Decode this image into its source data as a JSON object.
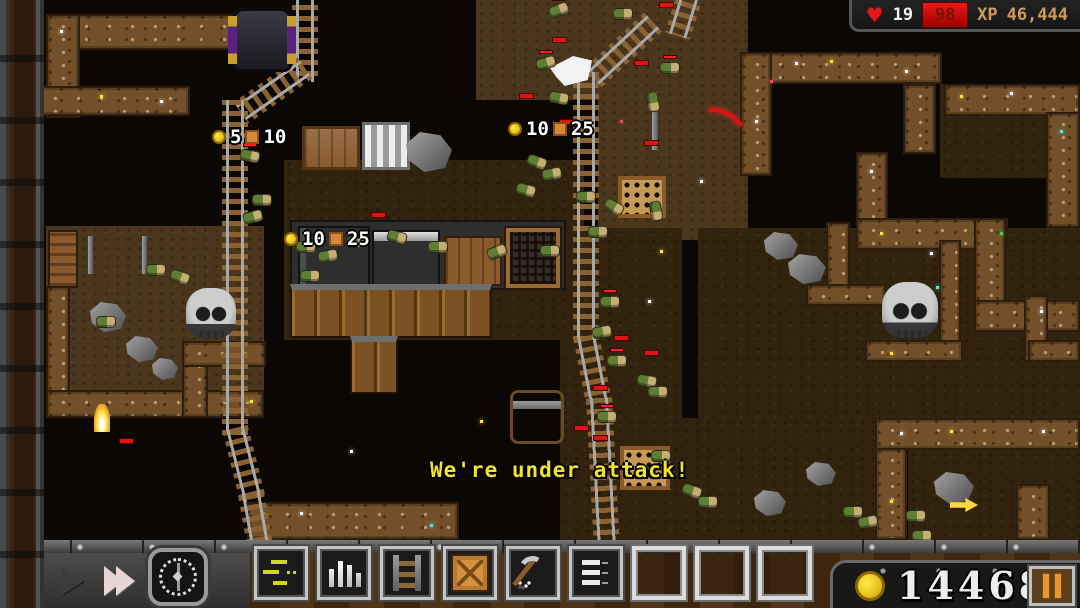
{
  "hud": {
    "lives": "19",
    "hp": "98",
    "xp_label": "XP",
    "xp_value": "46,444"
  },
  "gold": {
    "value": "14468"
  },
  "message": {
    "text": "We're under attack!",
    "x": 430,
    "y": 458
  },
  "loot_popups": [
    {
      "coin": "5",
      "crate": "10",
      "x": 212,
      "y": 126
    },
    {
      "coin": "10",
      "crate": "25",
      "x": 508,
      "y": 118
    },
    {
      "coin": "10",
      "crate": "25",
      "x": 284,
      "y": 228
    }
  ],
  "time_controls": {
    "play": "play",
    "fast_forward": "fast-forward",
    "clock": "day-night-clock"
  },
  "toolbar": {
    "slots": [
      {
        "id": 1,
        "icon": "tasks-list-icon",
        "filled": true
      },
      {
        "id": 2,
        "icon": "bar-chart-icon",
        "filled": true
      },
      {
        "id": 3,
        "icon": "ladder-icon",
        "filled": true
      },
      {
        "id": 4,
        "icon": "crate-icon",
        "filled": true
      },
      {
        "id": 5,
        "icon": "pickaxe-icon",
        "filled": true
      },
      {
        "id": 6,
        "icon": "list-icon",
        "filled": true
      },
      {
        "id": 7,
        "icon": "",
        "filled": false
      },
      {
        "id": 8,
        "icon": "",
        "filled": false
      },
      {
        "id": 9,
        "icon": "",
        "filled": false
      }
    ]
  },
  "colors": {
    "gold": "#f2d335",
    "hp_red": "#e01212",
    "xp_tan": "#d19b56",
    "message_yellow": "#f2e22e"
  },
  "scene": {
    "dirt": [
      [
        46,
        226,
        218,
        168,
        0
      ],
      [
        476,
        0,
        272,
        100,
        0
      ],
      [
        598,
        0,
        150,
        240,
        0
      ],
      [
        698,
        228,
        382,
        194,
        1
      ],
      [
        940,
        84,
        140,
        94,
        1
      ],
      [
        560,
        228,
        122,
        240,
        1
      ],
      [
        560,
        418,
        322,
        122,
        1
      ],
      [
        284,
        160,
        300,
        180,
        1
      ],
      [
        908,
        450,
        172,
        90,
        1
      ]
    ],
    "walls": [
      [
        46,
        14,
        190,
        36
      ],
      [
        46,
        14,
        34,
        104
      ],
      [
        38,
        86,
        152,
        30
      ],
      [
        740,
        52,
        202,
        32
      ],
      [
        740,
        52,
        32,
        124
      ],
      [
        903,
        84,
        33,
        70
      ],
      [
        944,
        84,
        136,
        32
      ],
      [
        1046,
        112,
        34,
        116
      ],
      [
        856,
        152,
        32,
        100
      ],
      [
        856,
        218,
        152,
        32
      ],
      [
        974,
        218,
        32,
        114
      ],
      [
        974,
        300,
        106,
        32
      ],
      [
        826,
        222,
        24,
        66
      ],
      [
        806,
        284,
        80,
        22
      ],
      [
        939,
        240,
        22,
        122
      ],
      [
        865,
        340,
        98,
        22
      ],
      [
        1024,
        295,
        24,
        67
      ],
      [
        1028,
        340,
        52,
        22
      ],
      [
        875,
        418,
        205,
        32
      ],
      [
        875,
        448,
        32,
        92
      ],
      [
        1016,
        484,
        34,
        56
      ],
      [
        46,
        286,
        24,
        110
      ],
      [
        46,
        390,
        218,
        28
      ],
      [
        182,
        341,
        26,
        77
      ],
      [
        182,
        341,
        84,
        26
      ],
      [
        247,
        502,
        212,
        38
      ]
    ],
    "rails": [
      [
        292,
        -6,
        88,
        0
      ],
      [
        292,
        68,
        78,
        55
      ],
      [
        222,
        100,
        335,
        0
      ],
      [
        222,
        428,
        74,
        -14
      ],
      [
        238,
        494,
        50,
        -10
      ],
      [
        678,
        -8,
        46,
        17
      ],
      [
        640,
        22,
        84,
        47
      ],
      [
        573,
        72,
        268,
        0
      ],
      [
        573,
        336,
        68,
        -11
      ],
      [
        586,
        398,
        144,
        -3
      ]
    ],
    "props": [
      {
        "t": "base",
        "x": 290,
        "y": 220,
        "w": 276,
        "h": 70
      },
      {
        "t": "machine",
        "x": 298,
        "y": 226,
        "w": 72,
        "h": 60
      },
      {
        "t": "machine2",
        "x": 372,
        "y": 230,
        "w": 68,
        "h": 56
      },
      {
        "t": "workbench",
        "x": 444,
        "y": 236,
        "w": 58,
        "h": 50
      },
      {
        "t": "furnace",
        "x": 506,
        "y": 228,
        "w": 54,
        "h": 60
      },
      {
        "t": "planks",
        "x": 290,
        "y": 284,
        "w": 202,
        "h": 54
      },
      {
        "t": "planks",
        "x": 350,
        "y": 336,
        "w": 48,
        "h": 58
      },
      {
        "t": "portal",
        "x": 232,
        "y": 8,
        "w": 60,
        "h": 64
      },
      {
        "t": "crate",
        "x": 302,
        "y": 126,
        "w": 58,
        "h": 44
      },
      {
        "t": "silverbox",
        "x": 362,
        "y": 122,
        "w": 48,
        "h": 48
      },
      {
        "t": "rock",
        "x": 406,
        "y": 132,
        "w": 46,
        "h": 40
      },
      {
        "t": "bench",
        "x": 48,
        "y": 230,
        "w": 30,
        "h": 58
      },
      {
        "t": "grate",
        "x": 618,
        "y": 176,
        "w": 48,
        "h": 42
      },
      {
        "t": "grate",
        "x": 620,
        "y": 446,
        "w": 50,
        "h": 44
      },
      {
        "t": "chest",
        "x": 510,
        "y": 390,
        "w": 54,
        "h": 54
      },
      {
        "t": "skull",
        "x": 186,
        "y": 288,
        "w": 50,
        "h": 50
      },
      {
        "t": "skull",
        "x": 882,
        "y": 282,
        "w": 56,
        "h": 56
      },
      {
        "t": "rock",
        "x": 90,
        "y": 302,
        "w": 36,
        "h": 30
      },
      {
        "t": "rock",
        "x": 126,
        "y": 336,
        "w": 32,
        "h": 26
      },
      {
        "t": "rock",
        "x": 152,
        "y": 358,
        "w": 26,
        "h": 22
      },
      {
        "t": "rock",
        "x": 764,
        "y": 232,
        "w": 34,
        "h": 28
      },
      {
        "t": "rock",
        "x": 788,
        "y": 254,
        "w": 38,
        "h": 30
      },
      {
        "t": "rock",
        "x": 934,
        "y": 472,
        "w": 40,
        "h": 32
      },
      {
        "t": "rock",
        "x": 806,
        "y": 462,
        "w": 30,
        "h": 24
      },
      {
        "t": "rock",
        "x": 754,
        "y": 490,
        "w": 32,
        "h": 26
      },
      {
        "t": "flame",
        "x": 94,
        "y": 404,
        "w": 16,
        "h": 28
      },
      {
        "t": "flag",
        "x": 550,
        "y": 56,
        "w": 42,
        "h": 30
      },
      {
        "t": "arc",
        "x": 696,
        "y": 110,
        "w": 50,
        "h": 32
      },
      {
        "t": "arrow",
        "x": 950,
        "y": 498,
        "w": 28,
        "h": 14
      },
      {
        "t": "pole",
        "x": 652,
        "y": 92,
        "w": 6,
        "h": 58
      },
      {
        "t": "pole",
        "x": 88,
        "y": 236,
        "w": 5,
        "h": 38
      },
      {
        "t": "pole",
        "x": 142,
        "y": 236,
        "w": 5,
        "h": 38
      }
    ],
    "goblins": [
      [
        549,
        4,
        -20,
        1
      ],
      [
        613,
        8,
        0,
        0
      ],
      [
        536,
        57,
        -15,
        1
      ],
      [
        549,
        92,
        10,
        0
      ],
      [
        643,
        96,
        80,
        0
      ],
      [
        660,
        62,
        0,
        1
      ],
      [
        527,
        156,
        20,
        0
      ],
      [
        542,
        168,
        -10,
        0
      ],
      [
        516,
        184,
        15,
        0
      ],
      [
        576,
        191,
        0,
        0
      ],
      [
        604,
        201,
        30,
        0
      ],
      [
        646,
        205,
        80,
        0
      ],
      [
        588,
        226,
        0,
        0
      ],
      [
        240,
        150,
        10,
        1
      ],
      [
        252,
        194,
        0,
        0
      ],
      [
        243,
        211,
        -15,
        0
      ],
      [
        146,
        264,
        0,
        0
      ],
      [
        170,
        271,
        20,
        0
      ],
      [
        96,
        316,
        0,
        0
      ],
      [
        296,
        241,
        0,
        0
      ],
      [
        318,
        250,
        -10,
        0
      ],
      [
        347,
        236,
        0,
        0
      ],
      [
        387,
        231,
        15,
        0
      ],
      [
        428,
        241,
        0,
        0
      ],
      [
        487,
        246,
        -20,
        0
      ],
      [
        540,
        245,
        0,
        0
      ],
      [
        300,
        270,
        0,
        0
      ],
      [
        600,
        296,
        0,
        1
      ],
      [
        592,
        326,
        -10,
        0
      ],
      [
        607,
        355,
        0,
        1
      ],
      [
        637,
        375,
        10,
        0
      ],
      [
        648,
        386,
        0,
        0
      ],
      [
        597,
        411,
        0,
        1
      ],
      [
        682,
        485,
        20,
        0
      ],
      [
        698,
        496,
        0,
        0
      ],
      [
        843,
        506,
        0,
        0
      ],
      [
        858,
        516,
        -10,
        0
      ],
      [
        906,
        510,
        0,
        0
      ],
      [
        651,
        450,
        0,
        0
      ],
      [
        912,
        530,
        0,
        0
      ]
    ],
    "marks": [
      [
        372,
        213
      ],
      [
        553,
        38
      ],
      [
        520,
        94
      ],
      [
        635,
        61
      ],
      [
        645,
        141
      ],
      [
        615,
        336
      ],
      [
        645,
        351
      ],
      [
        594,
        386
      ],
      [
        575,
        426
      ],
      [
        594,
        436
      ],
      [
        604,
        466
      ],
      [
        120,
        439
      ],
      [
        660,
        3
      ],
      [
        560,
        120
      ]
    ],
    "sparkles": [
      [
        795,
        62,
        "#ffffff"
      ],
      [
        830,
        60,
        "#ffe24a"
      ],
      [
        905,
        70,
        "#ffffff"
      ],
      [
        960,
        95,
        "#ffe24a"
      ],
      [
        1010,
        92,
        "#ffffff"
      ],
      [
        1060,
        130,
        "#5fe0e0"
      ],
      [
        870,
        170,
        "#ffffff"
      ],
      [
        880,
        232,
        "#ffe24a"
      ],
      [
        930,
        252,
        "#ffffff"
      ],
      [
        1000,
        232,
        "#58c858"
      ],
      [
        1040,
        310,
        "#ffffff"
      ],
      [
        936,
        286,
        "#5fe0e0"
      ],
      [
        890,
        352,
        "#ffe24a"
      ],
      [
        900,
        432,
        "#ffffff"
      ],
      [
        950,
        430,
        "#ffe24a"
      ],
      [
        1042,
        430,
        "#ffffff"
      ],
      [
        890,
        500,
        "#ffe24a"
      ],
      [
        770,
        80,
        "#e05050"
      ],
      [
        755,
        120,
        "#ffffff"
      ],
      [
        60,
        30,
        "#ffffff"
      ],
      [
        100,
        95,
        "#ffe24a"
      ],
      [
        160,
        100,
        "#ffffff"
      ],
      [
        250,
        400,
        "#ffe24a"
      ],
      [
        300,
        512,
        "#ffffff"
      ],
      [
        430,
        524,
        "#5fe0e0"
      ],
      [
        660,
        250,
        "#ffe24a"
      ],
      [
        700,
        180,
        "#ffffff"
      ],
      [
        620,
        120,
        "#e05050"
      ],
      [
        350,
        450,
        "#ffffff"
      ],
      [
        480,
        420,
        "#ffe24a"
      ],
      [
        648,
        300,
        "#ffffff"
      ],
      [
        866,
        18,
        "#ffe24a"
      ]
    ]
  }
}
